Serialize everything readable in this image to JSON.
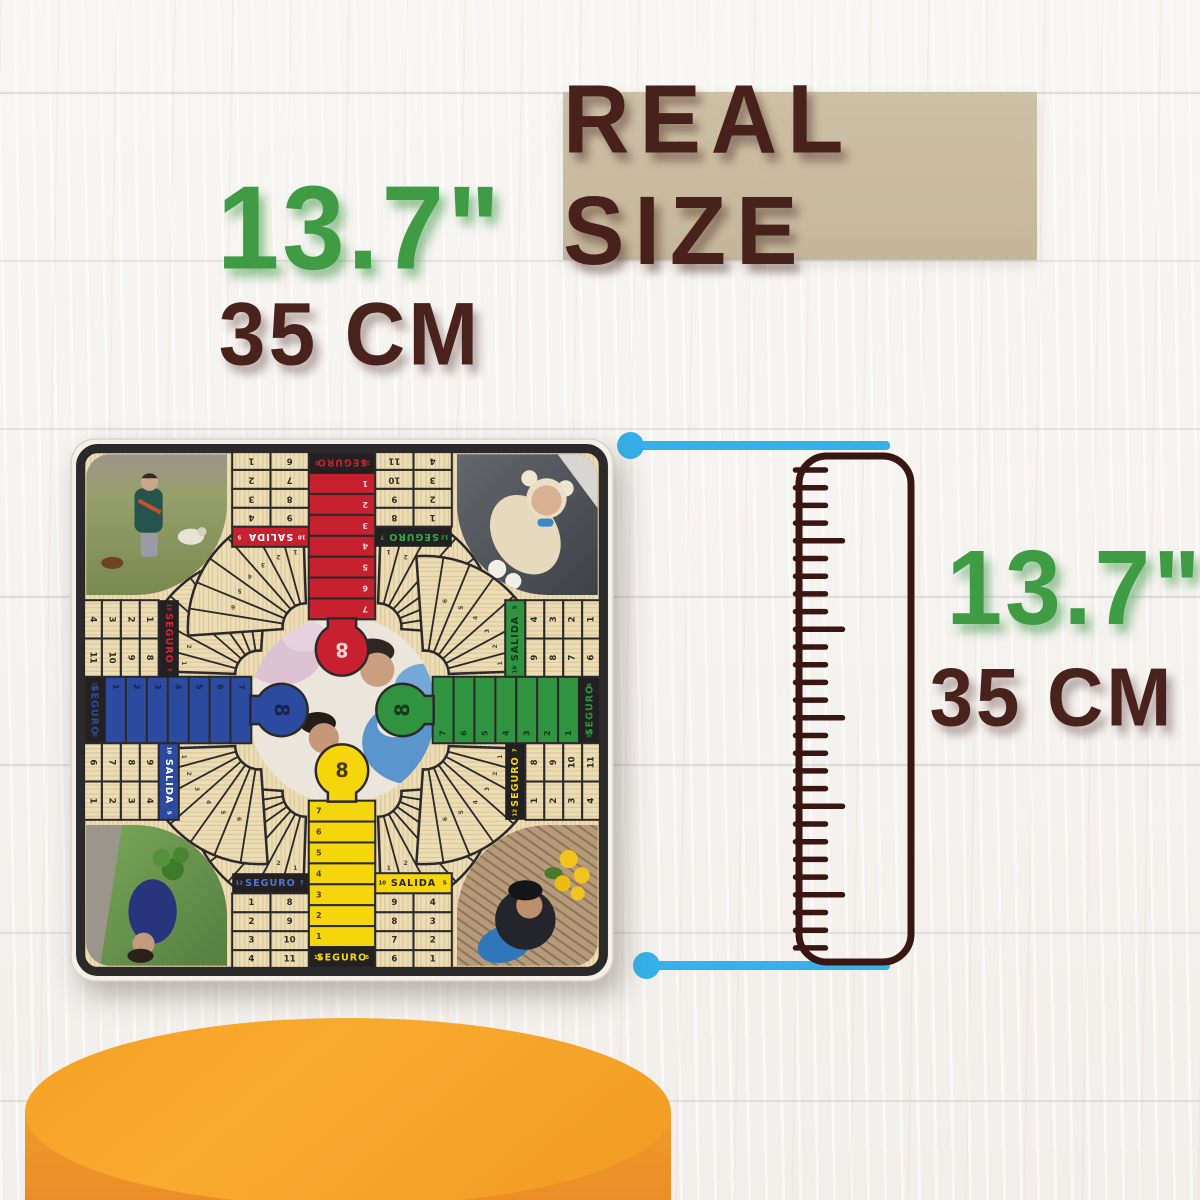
{
  "title": {
    "text": "REAL SIZE",
    "panel_color": "#c9bba1",
    "text_color": "#49211c"
  },
  "dims": {
    "left": {
      "inches": "13.7\"",
      "cm": "35 CM"
    },
    "right": {
      "inches": "13.7\"",
      "cm": "35 CM"
    },
    "inch_color": "#3f9b44",
    "cm_color": "#49221d"
  },
  "measure": {
    "line_color": "#35b0ea"
  },
  "ruler": {
    "outline_color": "#3a1613"
  },
  "podium": {
    "top_color": "#f6a82b",
    "side_color": "#ef9629"
  },
  "board": {
    "frame_color": "#2c292a",
    "wood_color": "#ecddb5",
    "tab": "8",
    "column_numbers": [
      "1",
      "2",
      "3",
      "4",
      "5",
      "6",
      "7"
    ],
    "fan_numbers": [
      "1",
      "2",
      "3",
      "4",
      "5",
      "6"
    ],
    "seguro_bar": {
      "label": "SEGURO",
      "sides": [
        "12",
        "5"
      ]
    },
    "grids": {
      "left": {
        "label": "SEGURO",
        "sides": [
          "12",
          "7"
        ],
        "cols": [
          [
            "1",
            "2",
            "3",
            "4"
          ],
          [
            "8",
            "9",
            "10",
            "11"
          ]
        ]
      },
      "right": {
        "label": "SALIDA",
        "sides": [
          "10",
          "5"
        ],
        "cols": [
          [
            "9",
            "8",
            "7",
            "6"
          ],
          [
            "4",
            "3",
            "2",
            "1"
          ]
        ]
      }
    },
    "arms": [
      {
        "id": "yellow",
        "rotation": 0,
        "color": "#f5d60c",
        "num_color": "#4a3c06",
        "label_color": "#2b2506",
        "neighbor_color": "#4f74d2"
      },
      {
        "id": "blue",
        "rotation": 90,
        "color": "#2c4ba0",
        "num_color": "#16254f",
        "label_color": "#ffffff",
        "neighbor_color": "#d42837"
      },
      {
        "id": "red",
        "rotation": 180,
        "color": "#c7202f",
        "num_color": "#f6d5d2",
        "label_color": "#ffffff",
        "neighbor_color": "#35a84a"
      },
      {
        "id": "green",
        "rotation": 270,
        "color": "#2f9340",
        "num_color": "#12391b",
        "label_color": "#103518",
        "neighbor_color": "#f5d60c"
      }
    ]
  }
}
